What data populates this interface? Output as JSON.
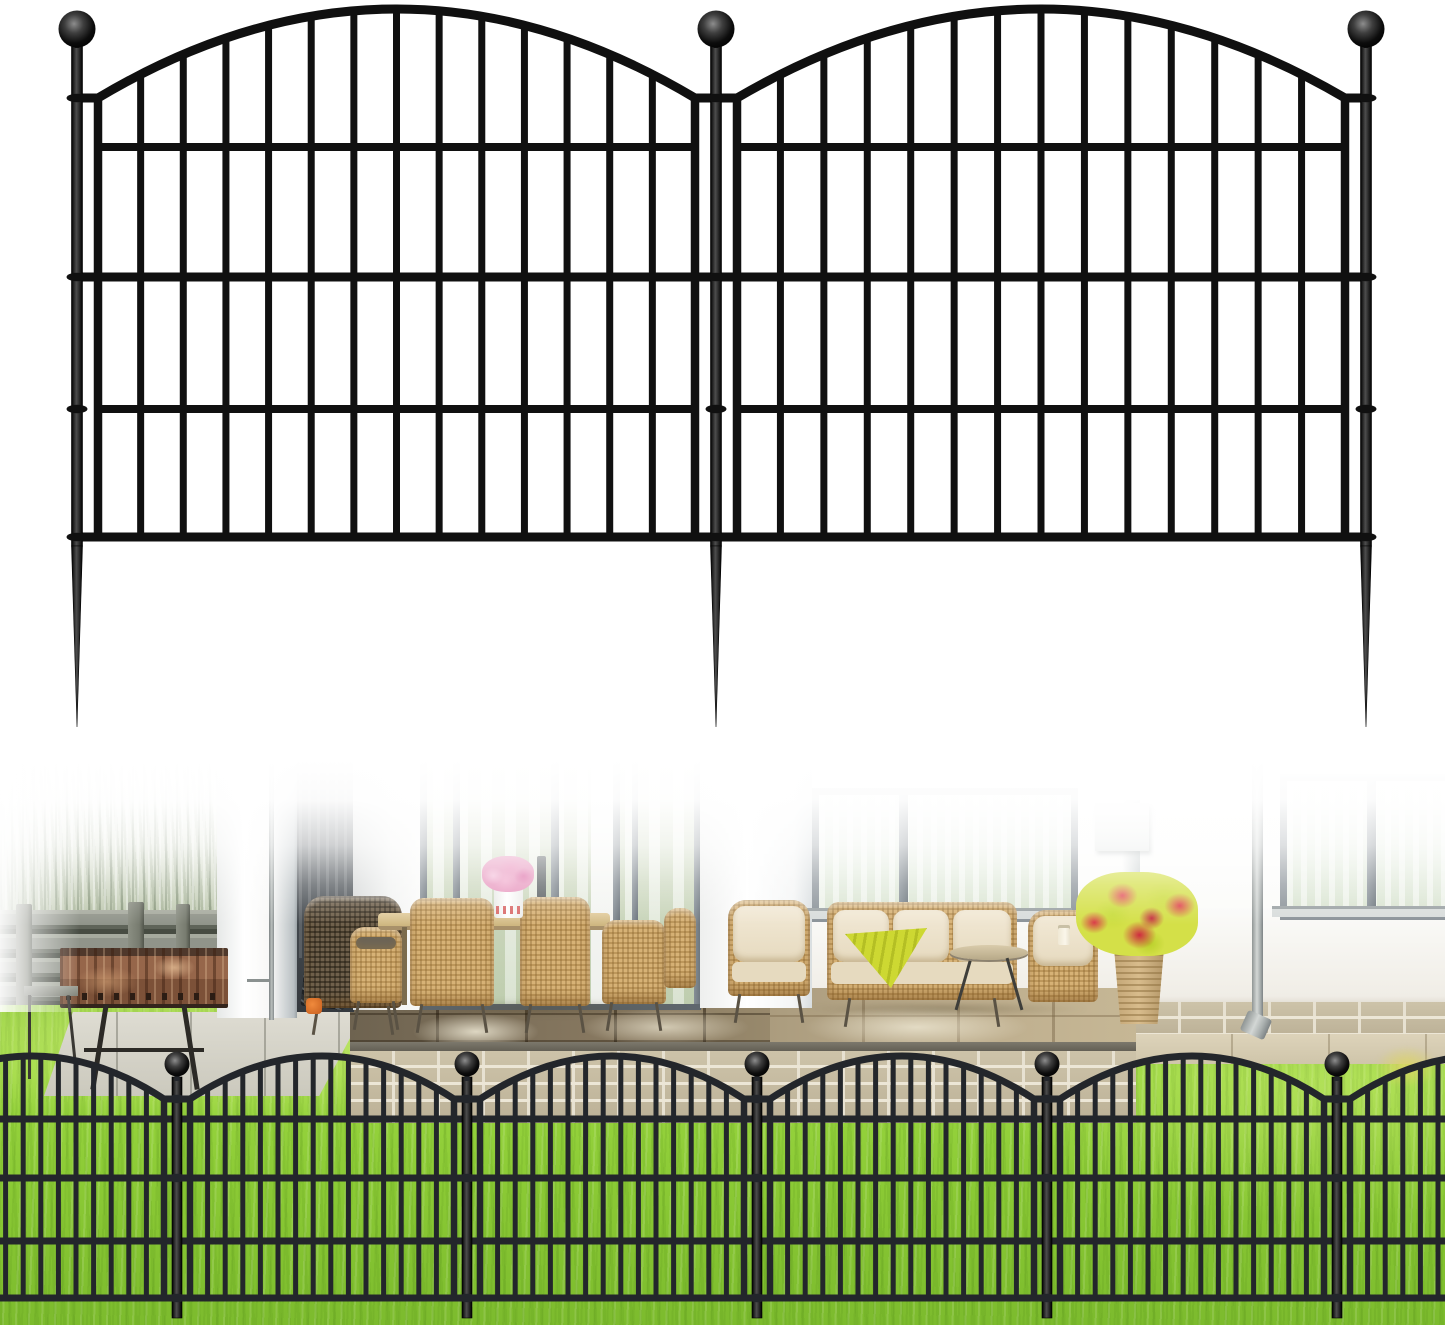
{
  "image_alt": "Black metal arched garden border fence: two-panel product illustration with ball finial posts and ground spikes, above a photo of the fence installed in a green lawn in front of a patio with white house, windows, wicker dining and lounge furniture, charcoal grill and red flower planter",
  "palette": {
    "background": "#ffffff",
    "illustration_fence_black": "#101010",
    "installed_fence_black": "#23262b",
    "lawn_green": "#8bca35",
    "tall_grass_green": "#a6b497",
    "wood_fence_gray": "#90948a",
    "grill_rust": "#96664a",
    "patio_tile_dark": "#877860",
    "patio_tile_light": "#beae8e",
    "brick_tan": "#c4ba9f",
    "wall_white": "#fbfbf9",
    "window_frame_gray": "#8a9298",
    "curtain_green": "#cdd9c2",
    "wicker_tan": "#d7b276",
    "cushion_beige": "#e6dabf",
    "throw_chartreuse": "#cdd832",
    "flowers_pink": "#e795bd",
    "flowers_red": "#e0404e",
    "foliage_chartreuse": "#cddd3e",
    "downspout_gray": "#b8bebc"
  },
  "illustration_fence": {
    "view": [
      0,
      0,
      1445,
      760
    ],
    "color": "#101010",
    "posts": [
      77,
      716,
      1366
    ],
    "draw_posts": [
      77,
      716,
      1366
    ],
    "post_w": 11,
    "post_top": 44,
    "post_bottom": 546,
    "spike_tip": 727,
    "ball": {
      "cy": 29,
      "r": 18.5
    },
    "arch": {
      "peak_y": 9,
      "base_y": 98,
      "w": 9,
      "inset": 21
    },
    "bars": {
      "count": 15,
      "w": 7,
      "bottom": 539
    },
    "rails_panel": [
      147,
      409
    ],
    "rails_full": [
      277,
      537
    ],
    "rail_w": 8,
    "collars": [
      98,
      277,
      409,
      537
    ]
  },
  "installed_fence": {
    "view": [
      0,
      760,
      1445,
      565
    ],
    "color": "#23262b",
    "posts": [
      -113,
      177,
      467,
      757,
      1047,
      1337,
      1627
    ],
    "draw_posts": [
      177,
      467,
      757,
      1047,
      1337
    ],
    "post_w": 10,
    "post_top": 1077,
    "post_bottom": 1318,
    "spike_tip": 0,
    "ball": {
      "cy": 1064,
      "r": 12.5
    },
    "arch": {
      "peak_y": 1056,
      "base_y": 1099,
      "w": 7,
      "inset": 13
    },
    "bars": {
      "count": 16,
      "w": 5,
      "bottom": 1300
    },
    "rails_panel": [],
    "rails_full": [
      1119,
      1178,
      1241,
      1298
    ],
    "rail_w": 6,
    "collars": [
      1099,
      1178,
      1298
    ]
  }
}
